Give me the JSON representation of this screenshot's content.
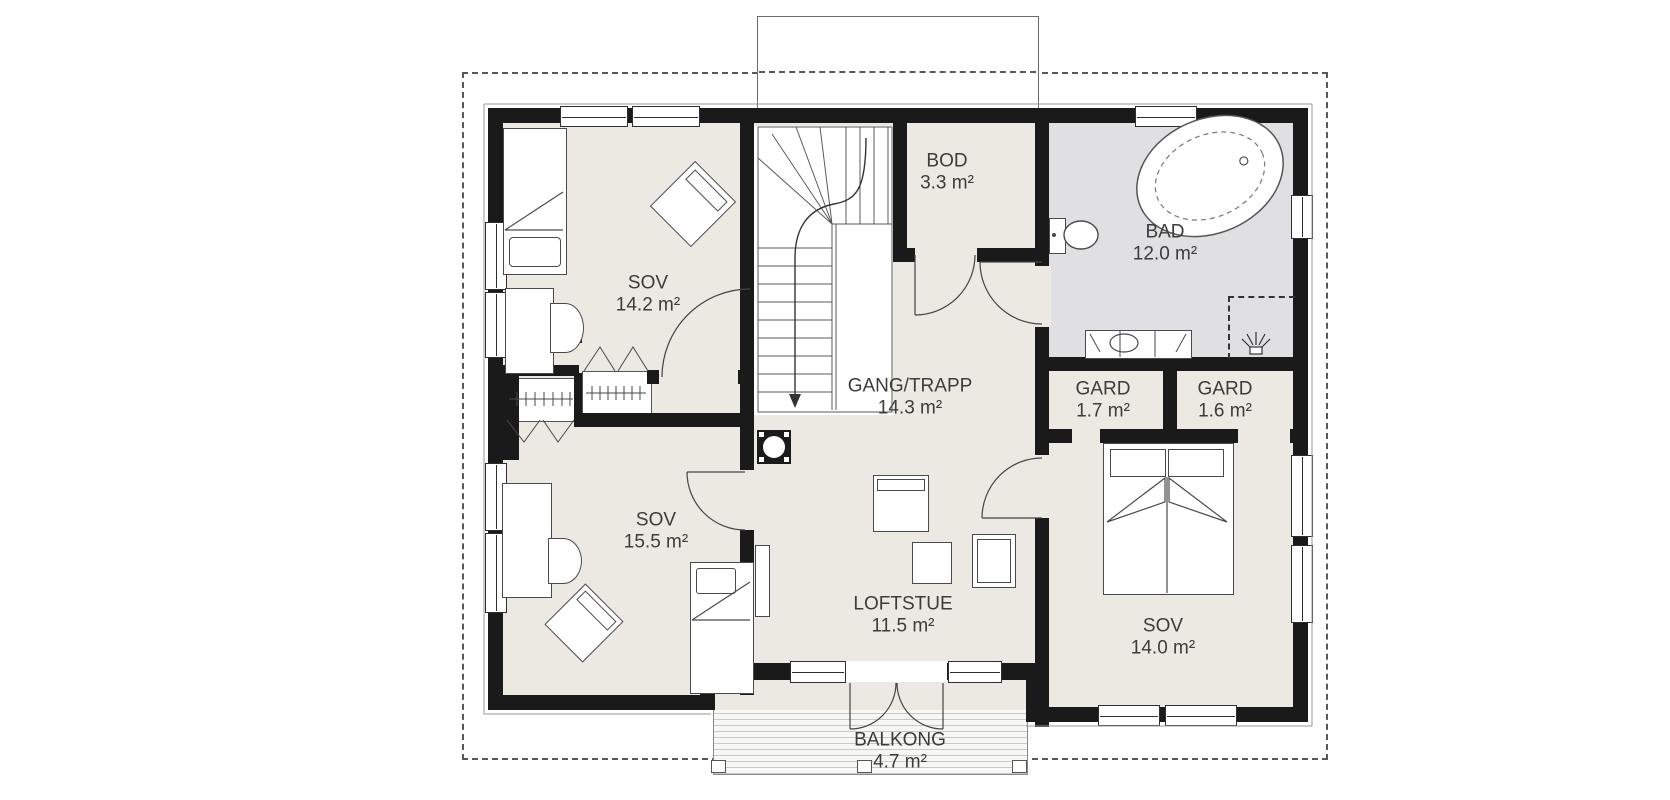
{
  "plan": {
    "title": "Floor plan - upper storey",
    "rooms": [
      {
        "id": "sov-14-2",
        "name": "SOV",
        "area": "14.2 m²"
      },
      {
        "id": "sov-15-5",
        "name": "SOV",
        "area": "15.5 m²"
      },
      {
        "id": "sov-14-0",
        "name": "SOV",
        "area": "14.0 m²"
      },
      {
        "id": "bod",
        "name": "BOD",
        "area": "3.3 m²"
      },
      {
        "id": "bad",
        "name": "BAD",
        "area": "12.0 m²"
      },
      {
        "id": "gang-trapp",
        "name": "GANG/TRAPP",
        "area": "14.3 m²"
      },
      {
        "id": "gard-1-7",
        "name": "GARD",
        "area": "1.7 m²"
      },
      {
        "id": "gard-1-6",
        "name": "GARD",
        "area": "1.6 m²"
      },
      {
        "id": "loftstue",
        "name": "LOFTSTUE",
        "area": "11.5 m²"
      },
      {
        "id": "balkong",
        "name": "BALKONG",
        "area": "4.7 m²"
      }
    ],
    "colors": {
      "wall": "#1a1a1a",
      "room_fill": "#ebe9e2",
      "bathroom_fill": "#e0e0e3",
      "background": "#ffffff",
      "text": "#3c3c3c"
    }
  }
}
